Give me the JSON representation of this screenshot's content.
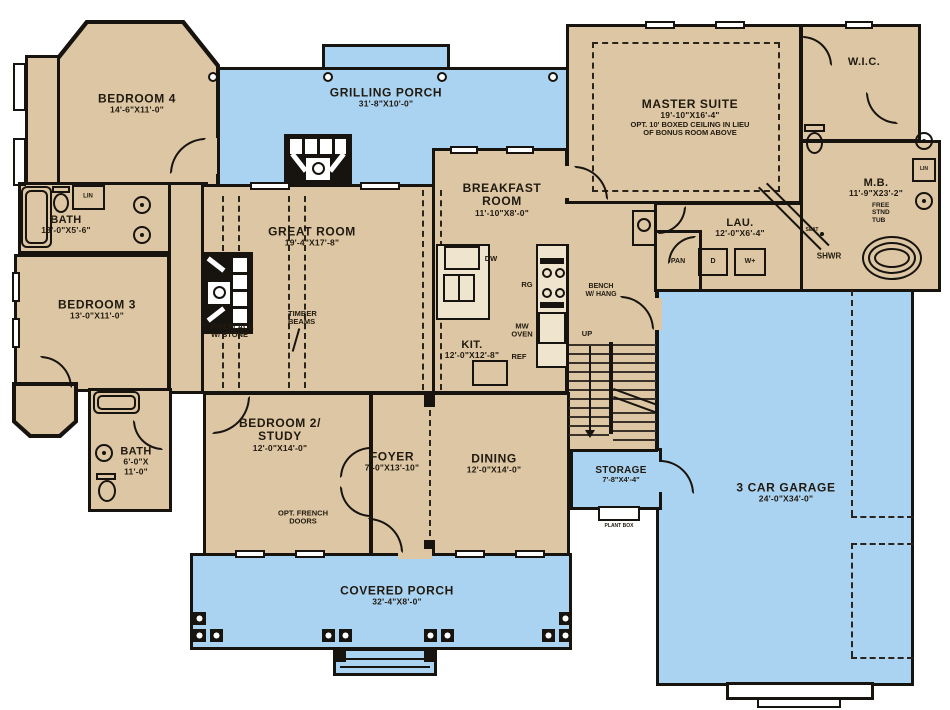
{
  "plan_title": "First floor plan",
  "colors": {
    "wall": "#17130e",
    "room_fill": "#dcc6a3",
    "porch_fill": "#a9d3f1",
    "background": "#ffffff"
  },
  "rooms": {
    "grilling_porch": {
      "name": "GRILLING PORCH",
      "dims": "31'-8\"X10'-0\""
    },
    "bedroom4": {
      "name": "BEDROOM 4",
      "dims": "14'-6\"X11'-0\""
    },
    "bath1": {
      "name": "BATH",
      "dims": "13'-0\"X5'-6\""
    },
    "bedroom3": {
      "name": "BEDROOM 3",
      "dims": "13'-0\"X11'-0\""
    },
    "bath2": {
      "name": "BATH",
      "dims1": "6'-0\"X",
      "dims2": "11'-0\""
    },
    "great_room": {
      "name": "GREAT ROOM",
      "dims": "19'-4\"X17'-8\""
    },
    "breakfast_room": {
      "name1": "BREAKFAST",
      "name2": "ROOM",
      "dims": "11'-10\"X8'-0\""
    },
    "kitchen": {
      "name": "KIT.",
      "dims": "12'-0\"X12'-8\""
    },
    "master_suite": {
      "name": "MASTER SUITE",
      "dims": "19'-10\"X16'-4\"",
      "note1": "OPT. 10' BOXED CEILING IN LIEU",
      "note2": "OF BONUS ROOM ABOVE"
    },
    "wic": {
      "name": "W.I.C."
    },
    "master_bath": {
      "name": "M.B.",
      "dims": "11'-9\"X23'-2\""
    },
    "laundry": {
      "name": "LAU.",
      "dims": "12'-0\"X6'-4\""
    },
    "bedroom2": {
      "name1": "BEDROOM 2/",
      "name2": "STUDY",
      "dims": "12'-0\"X14'-0\""
    },
    "foyer": {
      "name": "FOYER",
      "dims": "7'-0\"X13'-10\""
    },
    "dining": {
      "name": "DINING",
      "dims": "12'-0\"X14'-0\""
    },
    "storage": {
      "name": "STORAGE",
      "dims": "7'-8\"X4'-4\""
    },
    "garage": {
      "name": "3 CAR GARAGE",
      "dims": "24'-0\"X34'-0\""
    },
    "covered_porch": {
      "name": "COVERED PORCH",
      "dims": "32'-4\"X8'-0\""
    }
  },
  "labels": {
    "fireplace1": "FIREPLACE",
    "fireplace2": "W/ STONE",
    "timber1": "TIMBER",
    "timber2": "BEAMS",
    "french1": "OPT. FRENCH",
    "french2": "DOORS",
    "bench1": "BENCH",
    "bench2": "W/ HANG",
    "up": "UP",
    "dw": "DW",
    "rg": "RG",
    "mw1": "MW",
    "mw2": "OVEN",
    "ref": "REF",
    "pan": "PAN",
    "dryer": "D",
    "washer": "W+",
    "lin_bath": "LIN",
    "lin_mb": "LIN",
    "seat": "SEAT",
    "shwr": "SHWR",
    "tub1": "FREE",
    "tub2": "STND",
    "tub3": "TUB",
    "plant_box": "PLANT BOX"
  }
}
